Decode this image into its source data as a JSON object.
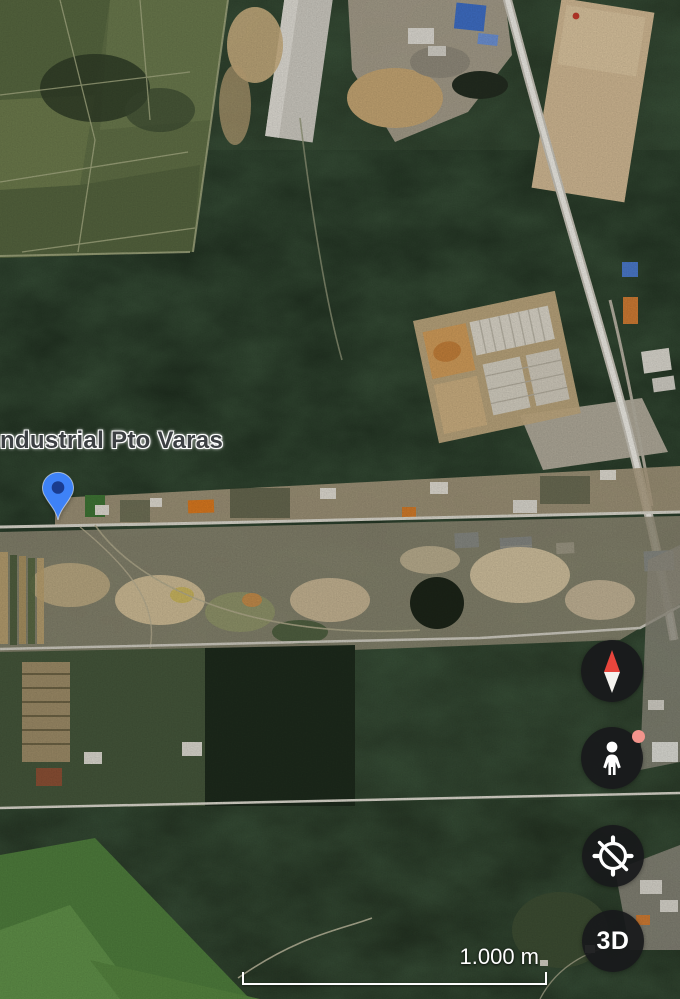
{
  "map": {
    "place_label": "ndustrial Pto Varas",
    "marker_color": "#3E82F7",
    "marker_inner_color": "#1A3C8F",
    "view_type": "satellite"
  },
  "controls": {
    "compass_icon": "compass-needle-icon",
    "pegman_icon": "street-view-pegman-icon",
    "tilt_icon": "compass-off-icon",
    "three_d_label": "3D",
    "button_bg": "#18191B",
    "pegman_badge_color": "#F2948C"
  },
  "scale_bar": {
    "distance_label": "1.000 m"
  },
  "colors": {
    "compass_red": "#E8453C",
    "needle_white": "#F5F3EF",
    "icon_white": "#FFFFFF",
    "label_text": "#3C4043",
    "label_halo": "#FFFFFF"
  }
}
